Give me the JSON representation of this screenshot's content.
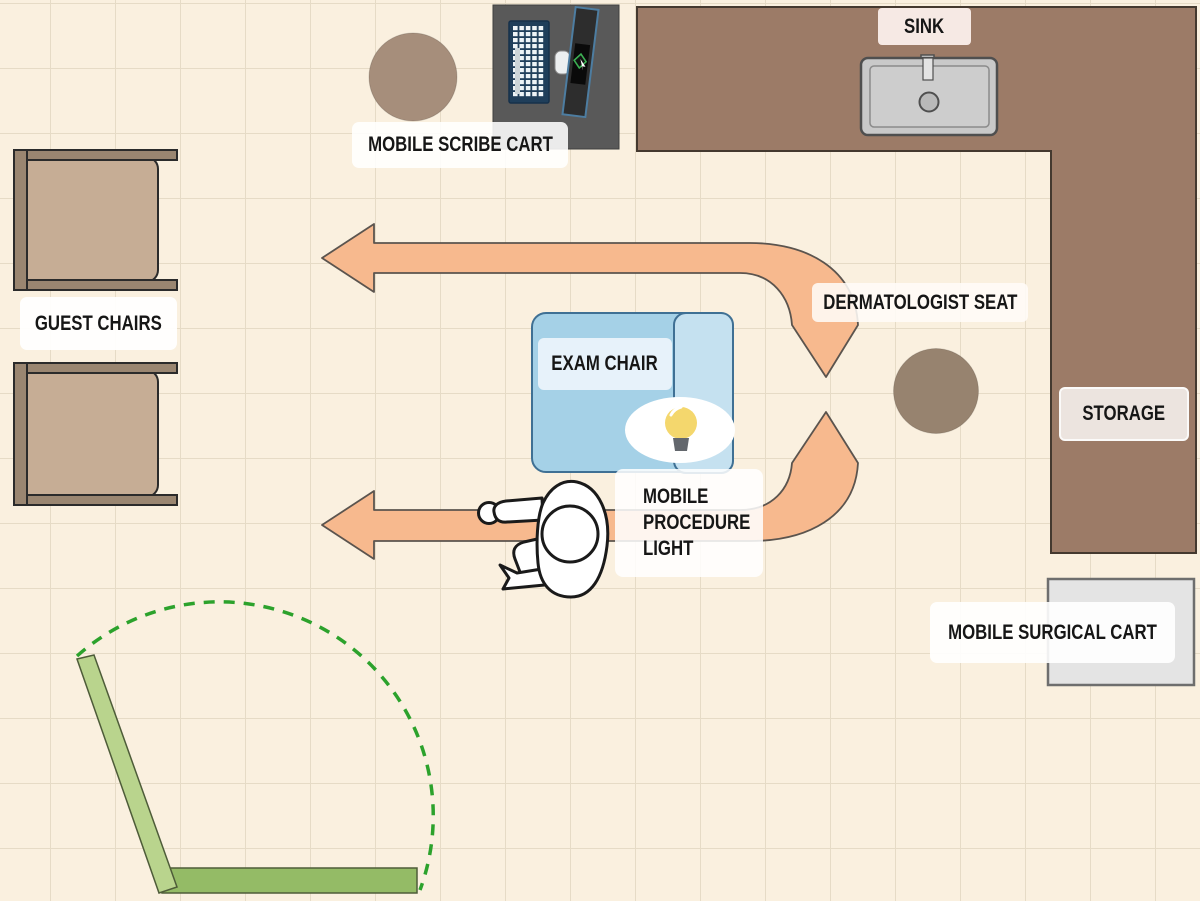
{
  "labels": {
    "sink": "SINK",
    "mobile_scribe_cart": "MOBILE SCRIBE CART",
    "guest_chairs": "GUEST CHAIRS",
    "exam_chair": "EXAM CHAIR",
    "dermatologist_seat": "DERMATOLOGIST SEAT",
    "storage": "STORAGE",
    "mobile_procedure_light": "MOBILE PROCEDURE LIGHT",
    "mobile_surgical_cart": "MOBILE SURGICAL CART"
  },
  "colors": {
    "background": "#faf0df",
    "grid_line": "#e6dbc6",
    "counter": "#9c7b67",
    "counter_border": "#44392f",
    "arrow": "#f7b98e",
    "arrow_border": "#5b544e",
    "exam_chair_body": "#a5d1e7",
    "exam_chair_pillow": "#c5e1f0",
    "exam_chair_border": "#3f7094",
    "door_leaf": "#b9d48d",
    "door_threshold": "#94bb66",
    "door_swing": "#2ca22c",
    "scribe_stool": "#a68e7b",
    "dermatologist_stool": "#97836f",
    "guest_chair_seat": "#c6ad95",
    "guest_chair_frame": "#9a8671",
    "sink_fixture": "#c9c9c9",
    "surgical_cart": "#e4e4e4",
    "scribe_cart": "#595959",
    "bulb": "#f4d76d",
    "label_text": "#161616"
  }
}
